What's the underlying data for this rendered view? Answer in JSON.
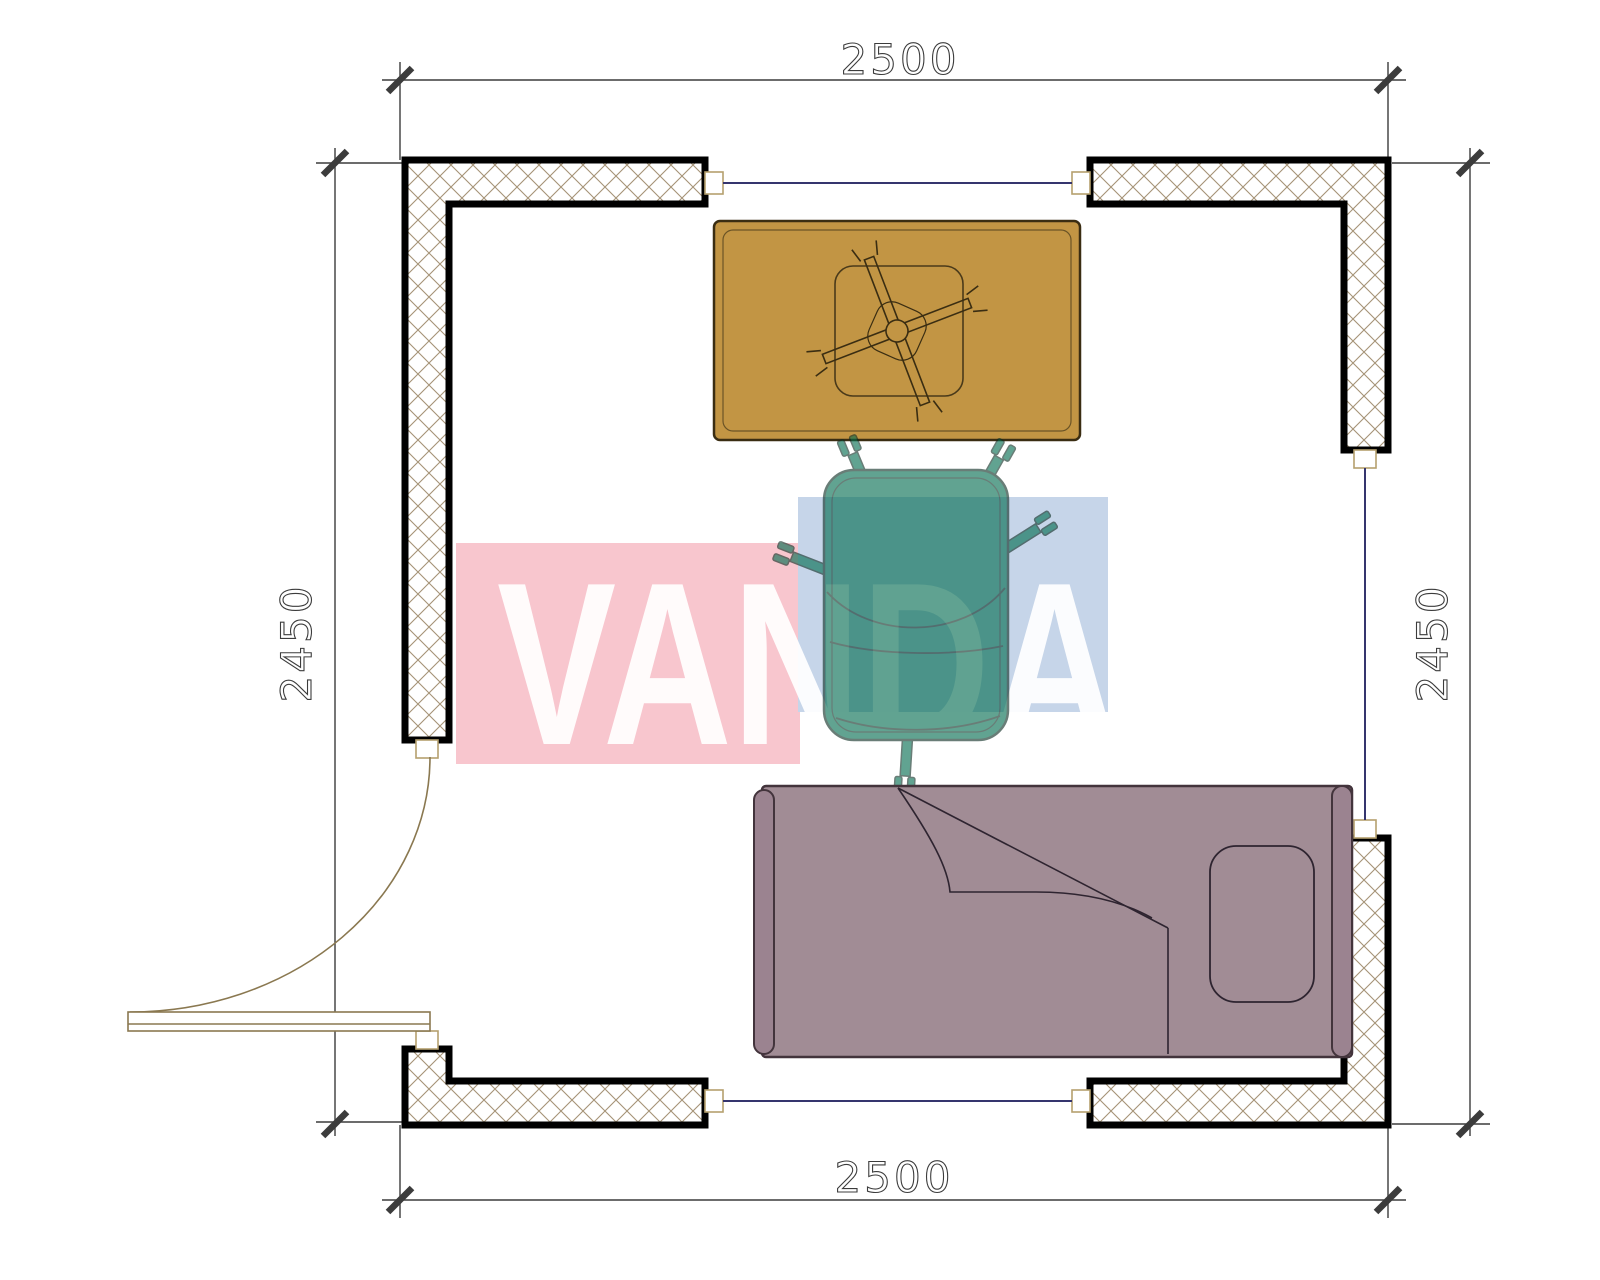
{
  "drawing": {
    "type": "architectural-floor-plan",
    "room": {
      "width_label": "2500",
      "depth_label": "2450"
    }
  },
  "dimensions": {
    "top": "2500",
    "bottom": "2500",
    "left": "2450",
    "right": "2450"
  },
  "watermark": {
    "text": "VANDA"
  },
  "objects": {
    "table": "table",
    "ceiling_fan": "ceiling-fan",
    "chair": "office-chair",
    "bed": "single-bed",
    "pillow": "pillow",
    "door": "swing-door",
    "window_top": "window",
    "window_right": "window",
    "window_bottom": "window"
  },
  "colors": {
    "table": "#c29544",
    "table_line": "#3a2d12",
    "chair": "#006b4e",
    "bed": "#a18c95",
    "bed_post": "#9b8390",
    "watermark_pink": "#f8c6ce",
    "watermark_blue": "#c6d5e9",
    "window_line": "#35356e",
    "wall_hatch": "#a59376",
    "jamb_border": "#b5a06e",
    "door_arc": "#8a7850",
    "dimension_line": "#3c3c3c"
  }
}
